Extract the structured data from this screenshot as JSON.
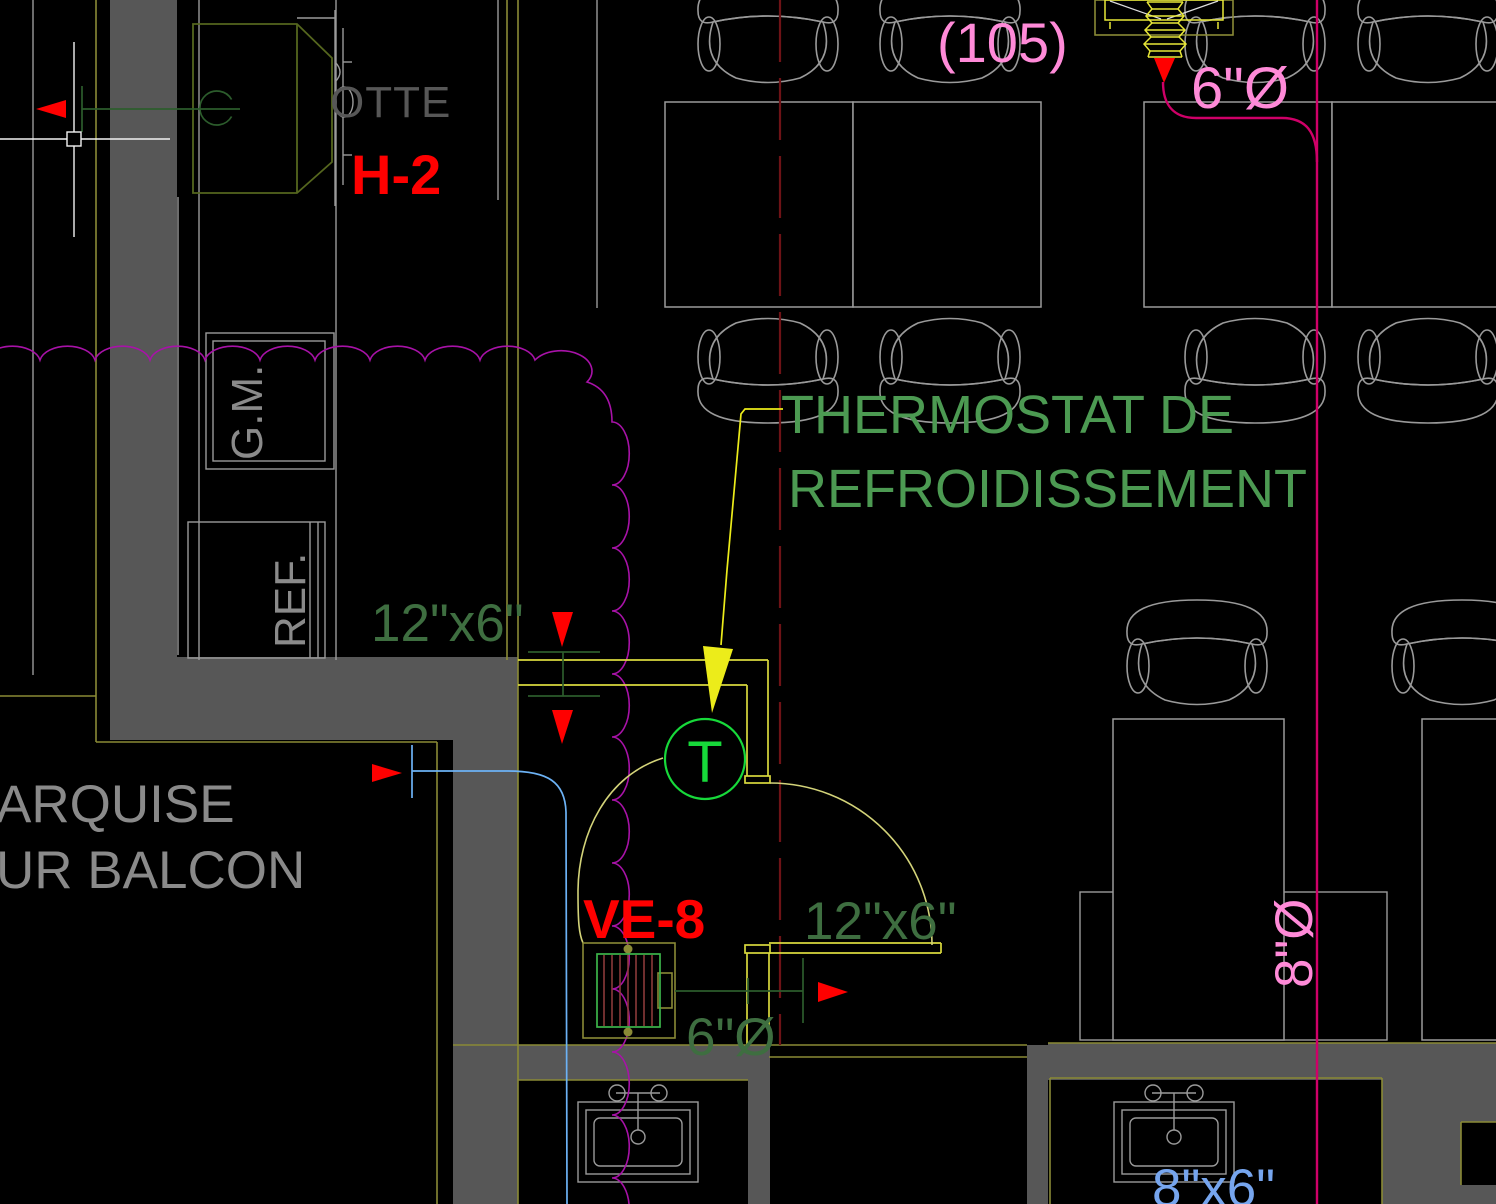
{
  "palette": {
    "bg": "#000000",
    "wall_gray": "#575757",
    "line_gray": "#9a9a9a",
    "text_gray": "#8a8a8a",
    "olive": "#8a8a36",
    "duct_yellow": "#d8d83e",
    "bellows_yellow": "#e8e838",
    "leader_yellow": "#ecec1a",
    "door_arc": "#d3d379",
    "dark_green": "#2c5c2c",
    "duct_text_green": "#3e6e40",
    "thermostat_green": "#4c9a52",
    "symbol_green": "#17d93a",
    "grille_green": "#3cb44a",
    "hatch_red": "#8b3a3a",
    "hood_olive": "#55661e",
    "red": "#ff0000",
    "maroon_dash": "#6e1216",
    "cloud_magenta": "#a812a8",
    "pink_line": "#cf0068",
    "pink_text": "#ff8ad8",
    "blue_text": "#76a5ee",
    "cyan_line": "#6cb2f5",
    "white": "#f2f2f2"
  },
  "labels": {
    "room_number": "(105)",
    "duct_6_top": "6\"Ø",
    "hood_name": "OTTE",
    "hood_tag": "H-2",
    "gm": "G.M.",
    "ref": "REF.",
    "thermostat_line1": "THERMOSTAT DE",
    "thermostat_line2": "REFROIDISSEMENT",
    "thermostat_symbol": "T",
    "duct_12x6_a": "12\"x6\"",
    "duct_12x6_b": "12\"x6\"",
    "ve8": "VE-8",
    "duct_6_bottom": "6\"Ø",
    "duct_8_right": "8\"Ø",
    "duct_8x6_bottom": "8\"x6\"",
    "marquise_line1": "ARQUISE",
    "marquise_line2": "UR BALCON"
  }
}
